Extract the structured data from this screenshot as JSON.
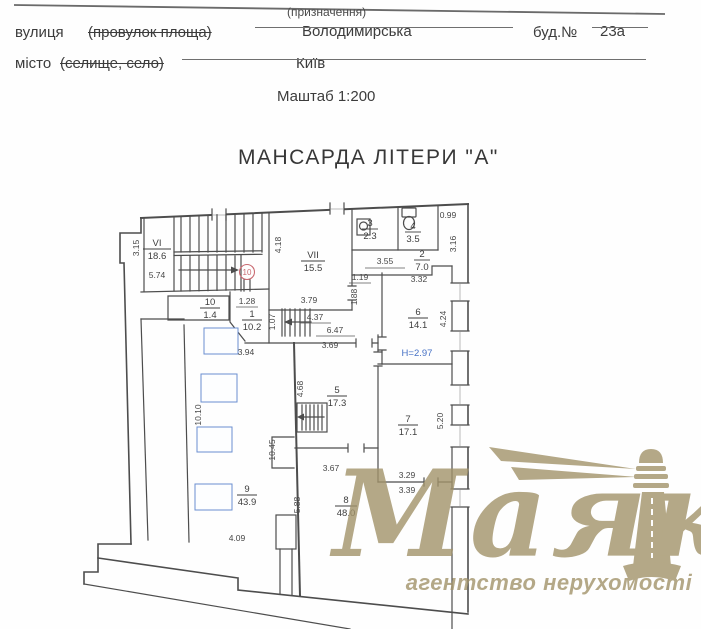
{
  "header": {
    "street_label": "вулиця",
    "street_strike": "(провулок площа)",
    "purpose_note": "(призначення)",
    "street_value": "Володимирська",
    "building_label": "буд.№",
    "building_value": "23а",
    "city_label": "місто",
    "city_strike": "(селище, село)",
    "city_value": "Київ",
    "scale_note": "Маштаб 1:200"
  },
  "title": "МАНСАРДА  ЛІТЕРИ \"А\"",
  "plan": {
    "circled_room": "10",
    "height_note": "H=2.97",
    "line_color": "#4d4d4d",
    "accent_blue": "#4671c5",
    "accent_red": "#c96b72",
    "skylight_color": "#6a8fd0",
    "rooms": {
      "rVI": {
        "num": "VI",
        "area": "18.6"
      },
      "rVII": {
        "num": "VII",
        "area": "15.5"
      },
      "r1": {
        "num": "1",
        "area": "10.2"
      },
      "r2": {
        "num": "2",
        "area": "7.0"
      },
      "r3": {
        "num": "3",
        "area": "2.3"
      },
      "r4": {
        "num": "4",
        "area": "3.5"
      },
      "r5": {
        "num": "5",
        "area": "17.3"
      },
      "r6": {
        "num": "6",
        "area": "14.1"
      },
      "r7": {
        "num": "7",
        "area": "17.1"
      },
      "r8": {
        "num": "8",
        "area": "48.0"
      },
      "r9": {
        "num": "9",
        "area": "43.9"
      },
      "r10": {
        "num": "10",
        "area": "1.4"
      }
    },
    "dims": {
      "d315": "3.15",
      "d574": "5.74",
      "d418": "4.18",
      "d379": "3.79",
      "d099": "0.99",
      "d316": "3.16",
      "d355": "3.55",
      "d119": "1.19",
      "d188": "1.88",
      "d332": "3.32",
      "d424": "4.24",
      "d128": "1.28",
      "d107": "1.07",
      "d437": "4.37",
      "d647": "6.47",
      "d369": "3.69",
      "d394": "3.94",
      "d468": "4.68",
      "d520": "5.20",
      "d329": "3.29",
      "d339": "3.39",
      "d367": "3.67",
      "d1010": "10.10",
      "d1045": "10.45",
      "d588": "5.88",
      "d409": "4.09"
    }
  },
  "watermark": {
    "brand": "Маяк",
    "tagline": "агентство нерухомості",
    "color": "#a2936a"
  }
}
